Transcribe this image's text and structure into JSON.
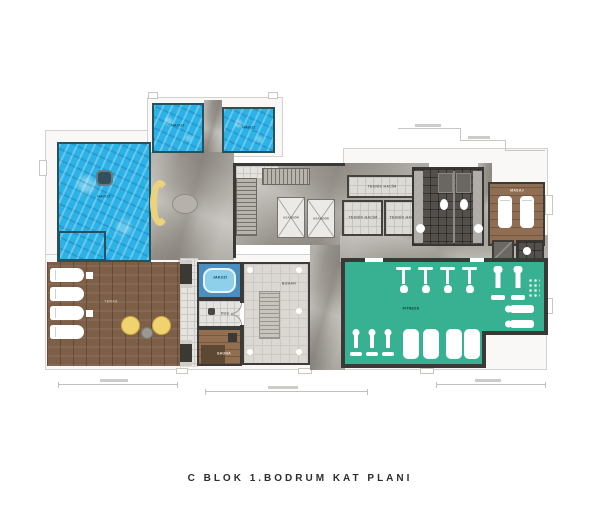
{
  "title": "C BLOK 1.BODRUM KAT PLANI",
  "labels": {
    "main_pool": "HAVUZ",
    "pool_top_left": "HAVUZ",
    "pool_top_right": "HAVUZ",
    "jacuzzi": "JAKUZİ",
    "shower": "DUŞ",
    "sauna": "SAUNA",
    "steam": "BUHAR",
    "fitness": "FITNESS",
    "massage": "MASAJ",
    "elevator": "ASANSÖR",
    "technical": "TEKNİK HACİM",
    "terrace": "TERAS"
  },
  "colors": {
    "pool_blue": "#2cb2e6",
    "gym_teal": "#38b193",
    "deck_wood": "#7d5f48",
    "marble_gray": "#a5a19a",
    "accent_yellow": "#ecd27c",
    "wall_dark": "#3b3936"
  }
}
